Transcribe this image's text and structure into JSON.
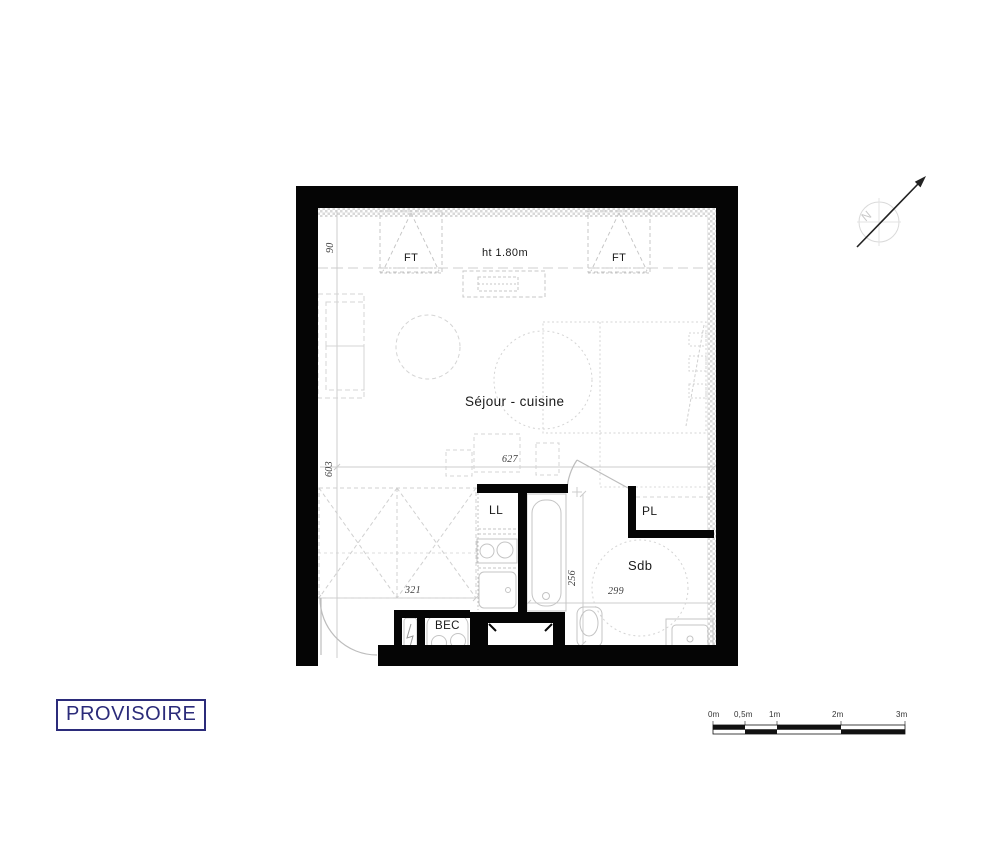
{
  "sheet": {
    "stamp": "PROVISOIRE"
  },
  "plan": {
    "rooms": {
      "living_kitchen": "Séjour - cuisine",
      "bathroom": "Sdb"
    },
    "features": {
      "closet": "PL",
      "washing_machine": "LL",
      "water_heater": "BEC",
      "roof_window_left": "FT",
      "roof_window_right": "FT",
      "ceiling_height_note": "ht 1.80m"
    },
    "dimensions": {
      "top_offset": "90",
      "room_depth": "603",
      "room_width": "627",
      "entry_width": "321",
      "bathroom_depth": "256",
      "bathroom_width": "299"
    },
    "north_letter": "N"
  },
  "scale_bar": {
    "labels": [
      "0m",
      "0,5m",
      "1m",
      "2m",
      "3m"
    ]
  },
  "colors": {
    "wall": "#050505",
    "stamp_navy": "#2b2b7a",
    "linework_gray": "#c8c8c8"
  }
}
